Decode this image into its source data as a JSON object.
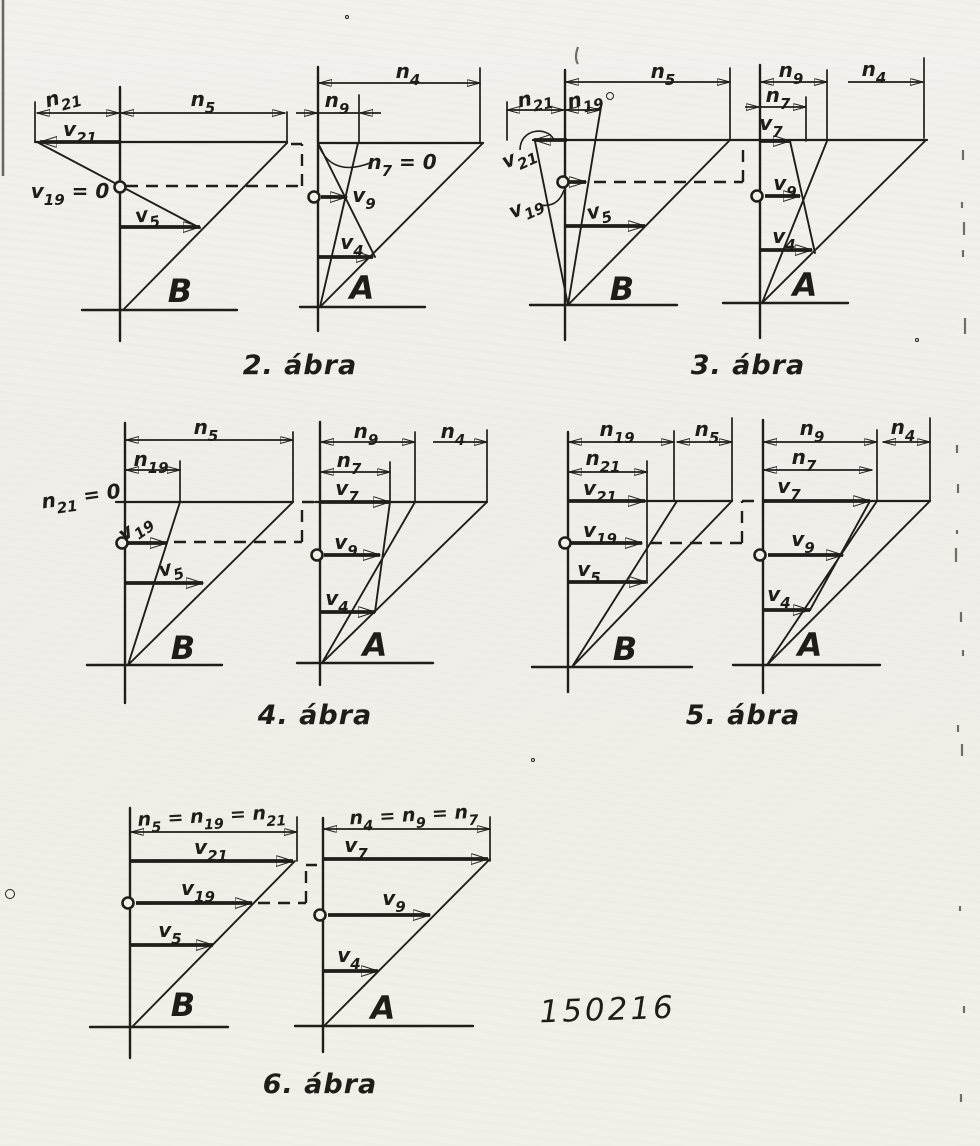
{
  "page": {
    "paper_color": "#f2efe9",
    "ink_color": "#211e1a",
    "stamp": "150216"
  },
  "figures": {
    "fig2": {
      "caption": "2. ábra",
      "labels": {
        "n21": "n_{21}",
        "n5": "n_{5}",
        "v21": "v_{21}",
        "v19_zero": "v_{19} = 0",
        "v5": "v_{5}",
        "wheel_b": "B",
        "n4": "n_{4}",
        "n9": "n_{9}",
        "n7_zero": "n_{7} = 0",
        "v9": "v_{9}",
        "v4": "v_{4}",
        "wheel_a": "A"
      }
    },
    "fig3": {
      "caption": "3. ábra",
      "labels": {
        "n5": "n_{5}",
        "n21": "n_{21}",
        "n19": "n_{19}",
        "v21": "v_{21}",
        "v19": "v_{19}",
        "v5": "v_{5}",
        "wheel_b": "B",
        "n9": "n_{9}",
        "n4": "n_{4}",
        "n7": "n_{7}",
        "v7": "v_{7}",
        "v9": "v_{9}",
        "v4": "v_{4}",
        "wheel_a": "A"
      }
    },
    "fig4": {
      "caption": "4. ábra",
      "labels": {
        "n5": "n_{5}",
        "n19": "n_{19}",
        "n21_zero": "n_{21} = 0",
        "v19": "v_{19}",
        "v5": "v_{5}",
        "wheel_b": "B",
        "n9": "n_{9}",
        "n4": "n_{4}",
        "n7": "n_{7}",
        "v7": "v_{7}",
        "v9": "v_{9}",
        "v4": "v_{4}",
        "wheel_a": "A"
      }
    },
    "fig5": {
      "caption": "5. ábra",
      "labels": {
        "n19": "n_{19}",
        "n5": "n_{5}",
        "n21": "n_{21}",
        "v21": "v_{21}",
        "v19": "v_{19}",
        "v5": "v_{5}",
        "wheel_b": "B",
        "n9": "n_{9}",
        "n4": "n_{4}",
        "n7": "n_{7}",
        "v7": "v_{7}",
        "v9": "v_{9}",
        "v4": "v_{4}",
        "wheel_a": "A"
      }
    },
    "fig6": {
      "caption": "6. ábra",
      "labels": {
        "dims_b": "n_{5} = n_{19} = n_{21}",
        "v21": "v_{21}",
        "v19": "v_{19}",
        "v5": "v_{5}",
        "wheel_b": "B",
        "dims_a": "n_{4} = n_{9} = n_{7}",
        "v7": "v_{7}",
        "v9": "v_{9}",
        "v4": "v_{4}",
        "wheel_a": "A"
      }
    }
  }
}
